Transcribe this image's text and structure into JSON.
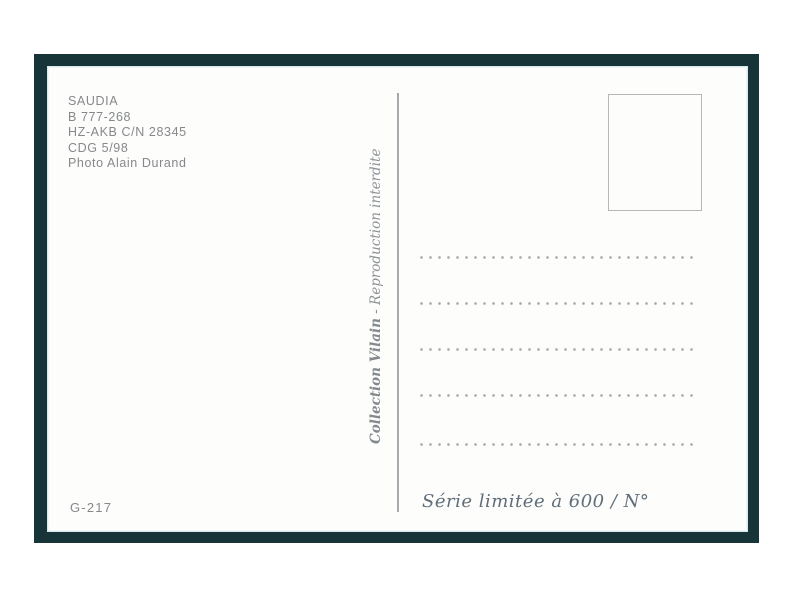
{
  "postcard": {
    "photo_info": {
      "lines": [
        "SAUDIA",
        "B 777-268",
        "HZ-AKB C/N 28345",
        "CDG 5/98",
        "Photo Alain Durand"
      ]
    },
    "credit": {
      "collection_name": "Collection Vilain",
      "separator": " - ",
      "notice": "Reproduction interdite"
    },
    "catalog_number": "G-217",
    "series_note": "Série limitée à 600 / N°",
    "address_line_count": 5
  },
  "colors": {
    "frame_green": "#173538",
    "card_white": "#fdfdfb",
    "caption_gray": "#86888b",
    "script_blue_gray": "#5f6e7a"
  }
}
